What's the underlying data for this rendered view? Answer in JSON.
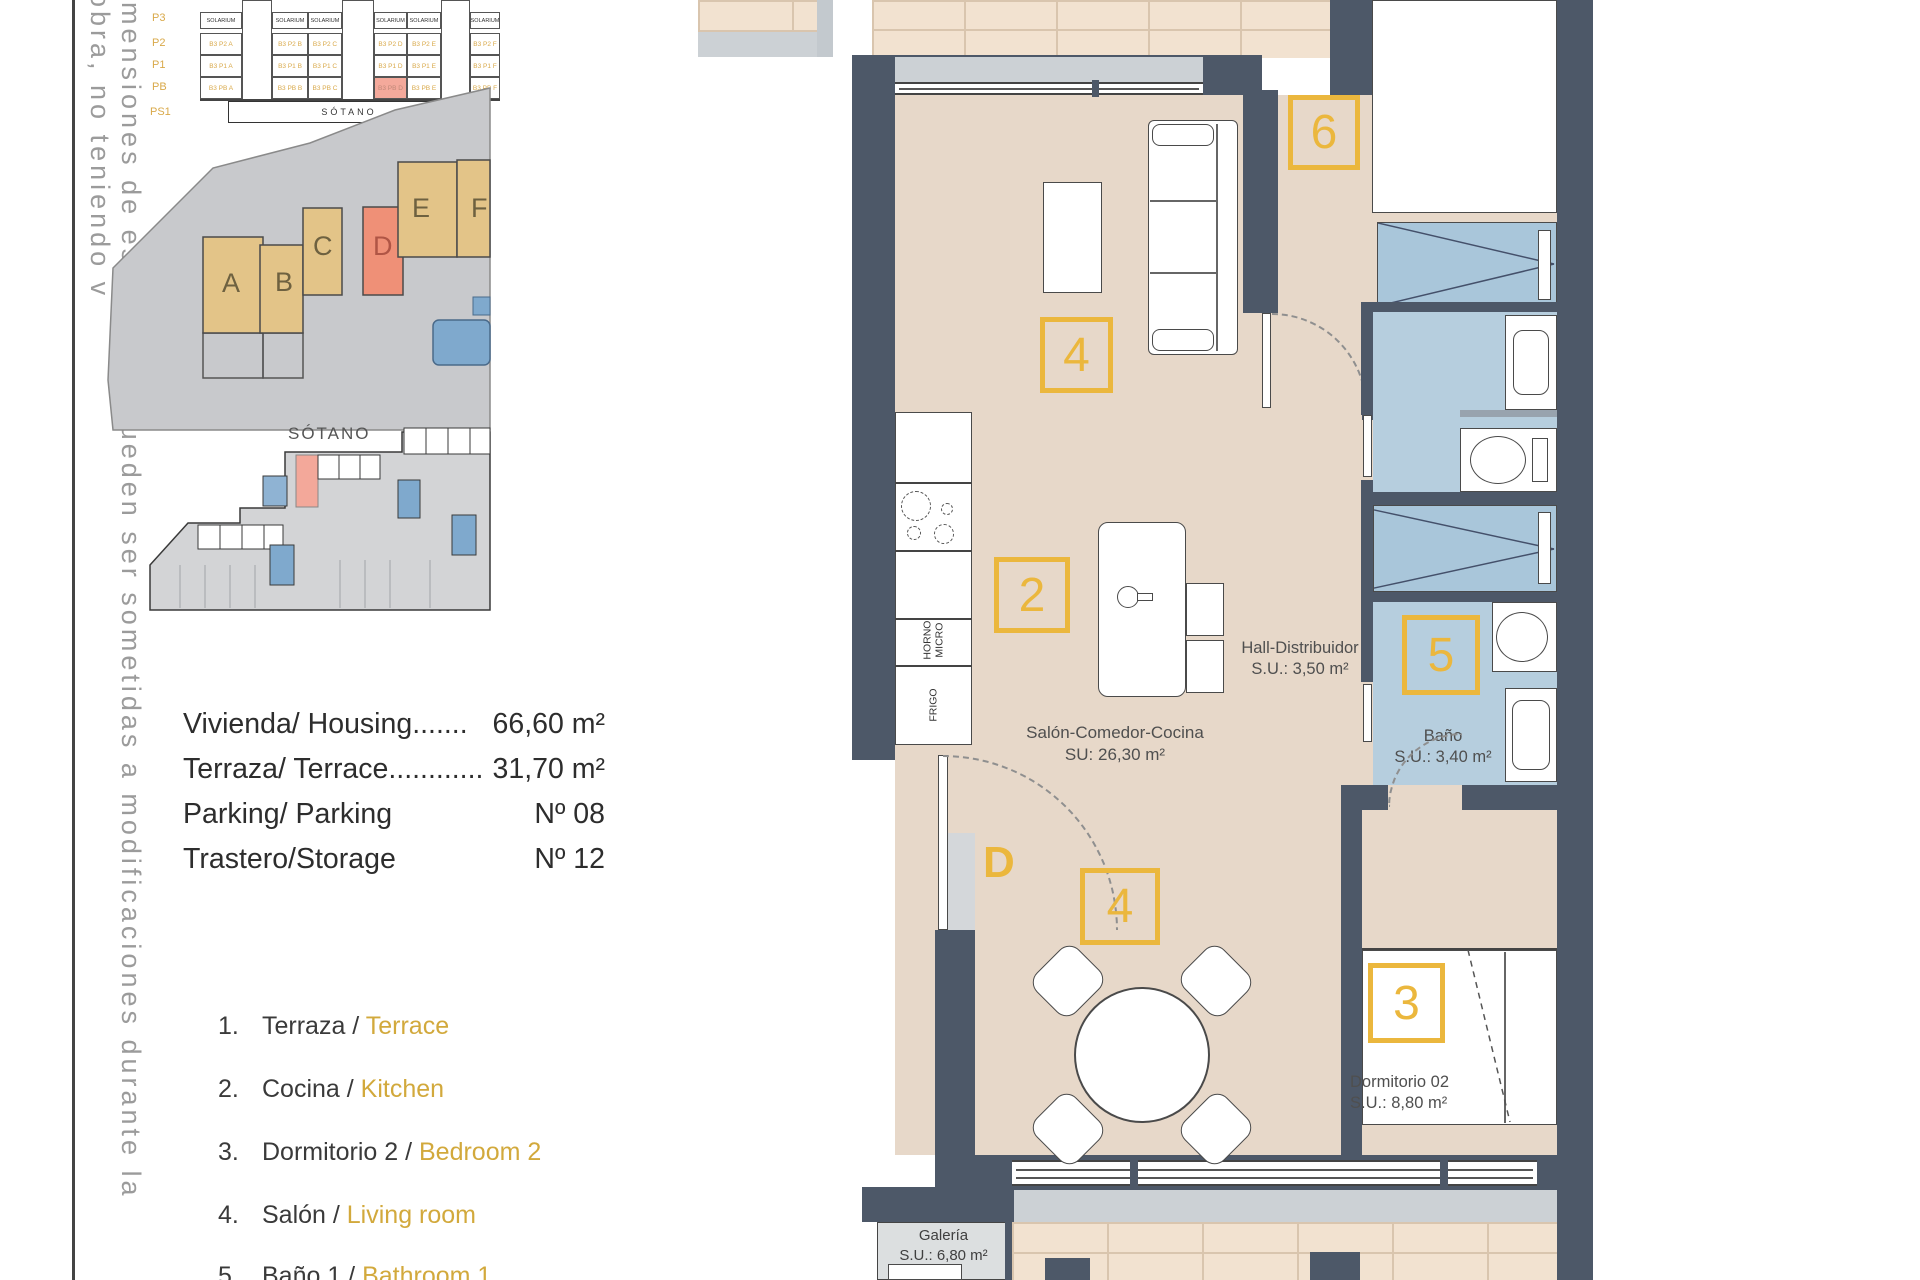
{
  "side_note": {
    "text": "imensiones de este plano pueden ser sometidas a modificaciones durante la obra, no teniendo v"
  },
  "section_diagram": {
    "floors": [
      "P3",
      "P2",
      "P1",
      "PB",
      "PS1"
    ],
    "solarium": "SOLARIUM",
    "sotano_label": "SÓTANO",
    "columns": [
      {
        "name": "A",
        "units": [
          "B3 P2 A",
          "B3 P1 A",
          "B3 PB A"
        ]
      },
      {
        "name": "B",
        "units": [
          "B3 P2 B",
          "B3 P1 B",
          "B3 PB B"
        ]
      },
      {
        "name": "C",
        "units": [
          "B3 P2 C",
          "B3 P1 C",
          "B3 PB C"
        ]
      },
      {
        "name": "D",
        "units": [
          "B3 P2 D",
          "B3 P1 D",
          "B3 PB D"
        ]
      },
      {
        "name": "E",
        "units": [
          "B3 P2 E",
          "B3 P1 E",
          "B3 PB E"
        ]
      },
      {
        "name": "F",
        "units": [
          "B3 P2 F",
          "B3 P1 F",
          "B3 PB F"
        ]
      }
    ]
  },
  "site_plan": {
    "buildings": [
      "A",
      "B",
      "C",
      "D",
      "E",
      "F"
    ],
    "highlighted_building": "D"
  },
  "basement": {
    "title": "SÓTANO"
  },
  "summary": {
    "rows": [
      {
        "label": "Vivienda/ Housing.......",
        "value": "66,60 m²"
      },
      {
        "label": "Terraza/ Terrace............",
        "value": "31,70 m²"
      },
      {
        "label": "Parking/ Parking",
        "value": "Nº 08"
      },
      {
        "label": "Trastero/Storage",
        "value": "Nº 12"
      }
    ]
  },
  "legend": {
    "items": [
      {
        "num": "1.",
        "es": "Terraza / ",
        "en": "Terrace"
      },
      {
        "num": "2.",
        "es": "Cocina / ",
        "en": "Kitchen"
      },
      {
        "num": "3.",
        "es": "Dormitorio 2 / ",
        "en": "Bedroom 2"
      },
      {
        "num": "4.",
        "es": "Salón / ",
        "en": "Living room"
      },
      {
        "num": "5.",
        "es": "Baño 1 / ",
        "en": "Bathroom 1"
      }
    ]
  },
  "floor_plan": {
    "markers": {
      "six": "6",
      "four": "4",
      "two": "2",
      "five": "5",
      "three": "3",
      "door": "D"
    },
    "labels": {
      "salon1": "Salón-Comedor-Cocina",
      "salon2": "SU: 26,30 m²",
      "hall1": "Hall-Distribuidor",
      "hall2": "S.U.: 3,50 m²",
      "bano1": "Baño",
      "bano2": "S.U.: 3,40 m²",
      "dorm1": "Dormitorio 02",
      "dorm2": "S.U.: 8,80 m²",
      "gal1": "Galería",
      "gal2": "S.U.: 6,80 m²",
      "horno1": "HORNO",
      "horno2": "MICRO",
      "frigo": "FRIGO"
    },
    "colors": {
      "wall": "#4d5868",
      "floor": "#e7d8c9",
      "bathroom": "#b6cede",
      "wardrobe": "#a9c6da",
      "terrace": "#f2e2d0",
      "accent": "#ebb73d",
      "highlight_red": "#f4a99b"
    }
  }
}
